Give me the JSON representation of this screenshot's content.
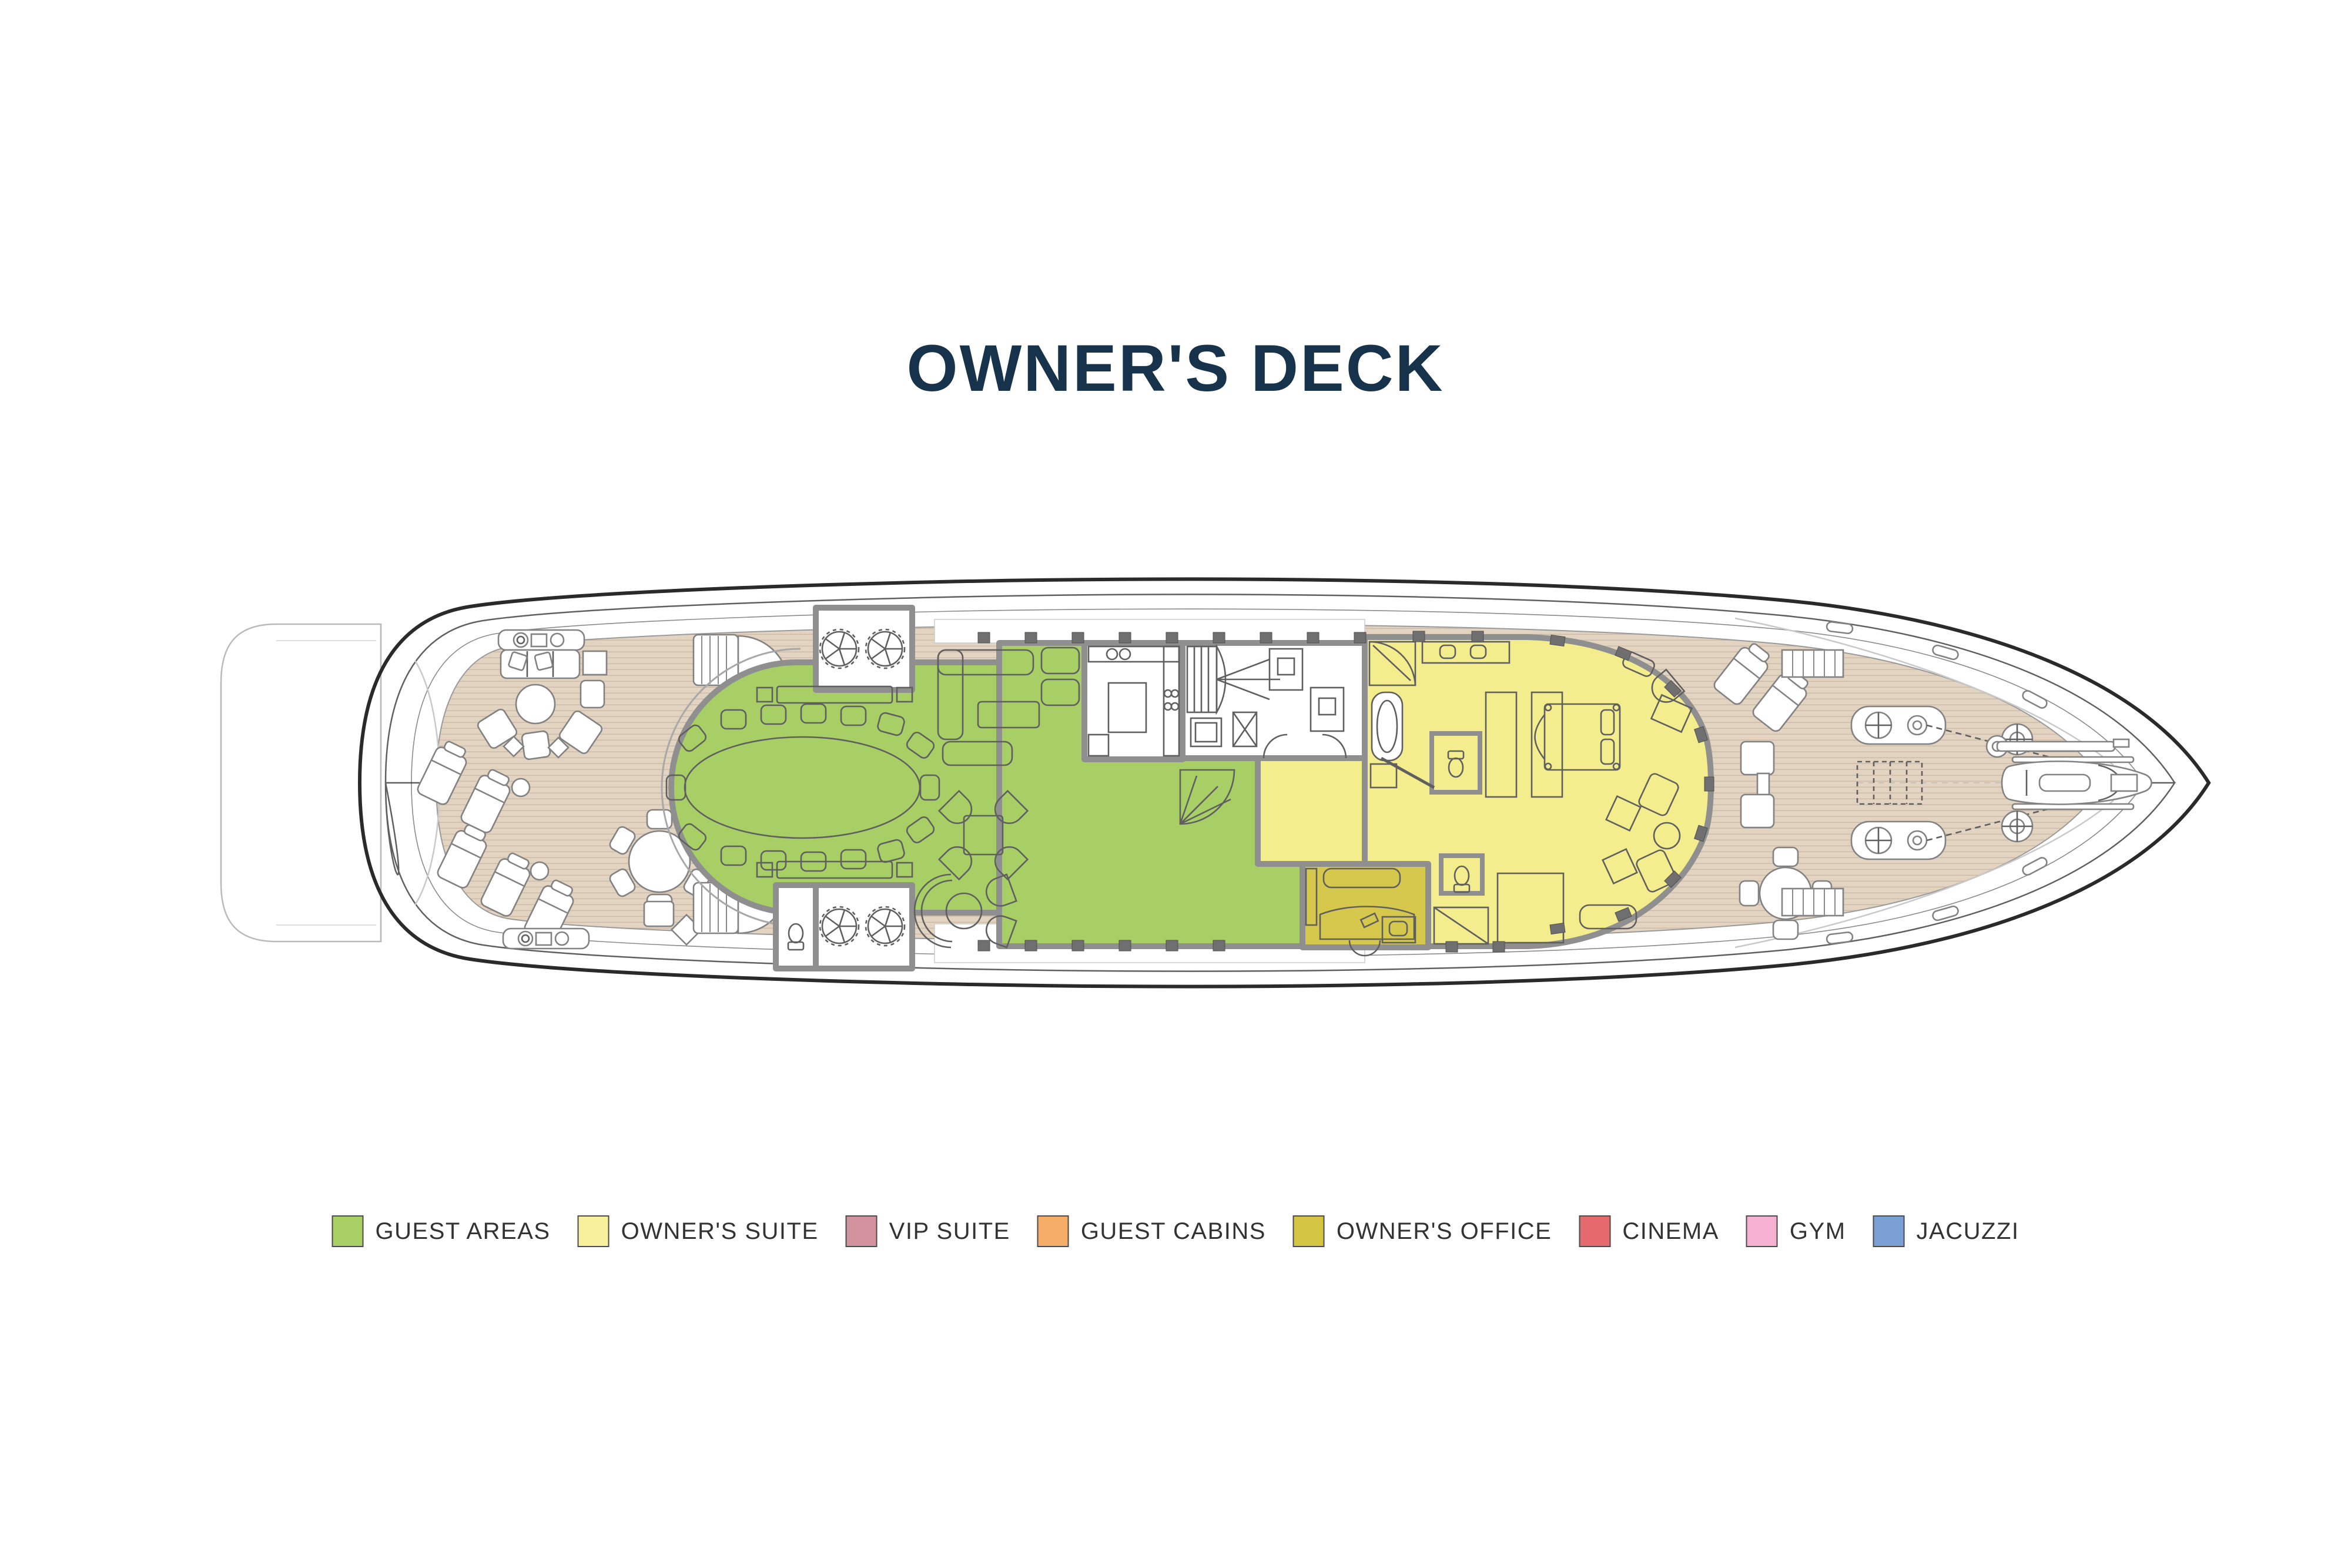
{
  "title": {
    "text": "OWNER'S DECK",
    "color": "#16334b"
  },
  "legend": {
    "text_color": "#333333",
    "swatch_border": "#4c4c4c",
    "items": [
      {
        "id": "guest-areas",
        "label": "GUEST AREAS",
        "color": "#a7cf63"
      },
      {
        "id": "owners-suite",
        "label": "OWNER'S SUITE",
        "color": "#f7f19b"
      },
      {
        "id": "vip-suite",
        "label": "VIP SUITE",
        "color": "#d2939f"
      },
      {
        "id": "guest-cabins",
        "label": "GUEST CABINS",
        "color": "#f5ad68"
      },
      {
        "id": "owners-office",
        "label": "OWNER'S OFFICE",
        "color": "#d3c441"
      },
      {
        "id": "cinema",
        "label": "CINEMA",
        "color": "#e6696d"
      },
      {
        "id": "gym",
        "label": "GYM",
        "color": "#f6b0d1"
      },
      {
        "id": "jacuzzi",
        "label": "JACUZZI",
        "color": "#7ba0d5"
      }
    ]
  },
  "plan": {
    "colors": {
      "deck": "#e3d3c1",
      "plank_line": "#cdbaa6",
      "wall": "#8f8f8f",
      "hull": "#2a2a2a",
      "guest_areas": "#a8cf66",
      "owners_suite": "#f3ed8e",
      "owners_office": "#d6c74d",
      "service_room": "#ffffff",
      "furniture_line": "#5f5f5f",
      "deck_furniture_line": "#828282",
      "mullion": "#6f6f6f"
    }
  }
}
